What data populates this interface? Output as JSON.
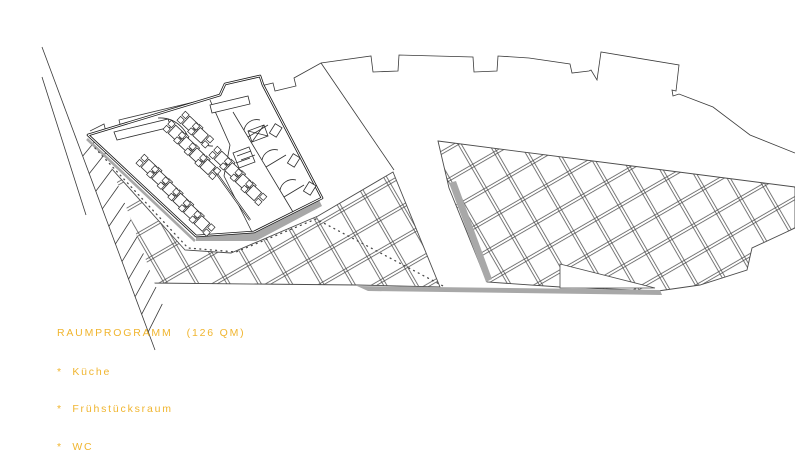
{
  "program": {
    "title": "RAUMPROGRAMM   (126 QM)",
    "items": [
      "*  Küche",
      "*  Frühstücksraum",
      "*  WC"
    ]
  },
  "palette": {
    "accent_text": "#f0b52f",
    "drawing_line": "#2c2c2c",
    "shadow_gray": "#a8a8a8",
    "background": "#ffffff"
  },
  "drawing": {
    "kind": "architectural site / floor plan",
    "features": [
      "building-facade",
      "breakfast-room",
      "kitchen",
      "wc-stalls",
      "dining-tables",
      "plaza-tile-grid",
      "stairs",
      "footpath-dotted"
    ]
  }
}
